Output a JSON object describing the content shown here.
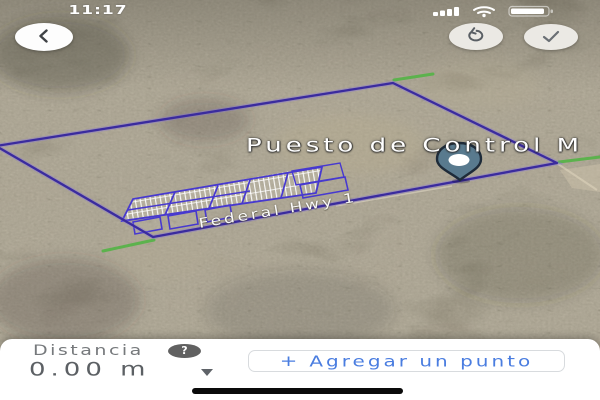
{
  "status_bar": {
    "time": "11:17"
  },
  "map": {
    "place_label": "Puesto de Control M",
    "road_label": "Federal Hwy 1"
  },
  "bottom_panel": {
    "title": "Distancia",
    "help": "?",
    "value": "0.00 m",
    "add_button": {
      "plus": "+",
      "label": "Agregar un punto"
    }
  },
  "icons": {
    "back": "chevron-left",
    "undo": "rotate-ccw-arrow",
    "confirm": "checkmark",
    "help": "question-mark",
    "value_dropdown": "chevron-down",
    "add": "plus",
    "place_marker": "map-pin",
    "status": [
      "cellular-signal",
      "wifi",
      "battery"
    ]
  },
  "colors": {
    "measure_polygon": "#3a2b9e",
    "subdivision_streets": "#4739cf",
    "road_overlay_green": "#5cb24d",
    "pin_fill": "#597a8e",
    "pin_outline": "#1e2b39",
    "accent_blue": "#4a7de0",
    "panel_text_gray": "#5f6368",
    "terrain_base": "#948a76"
  }
}
